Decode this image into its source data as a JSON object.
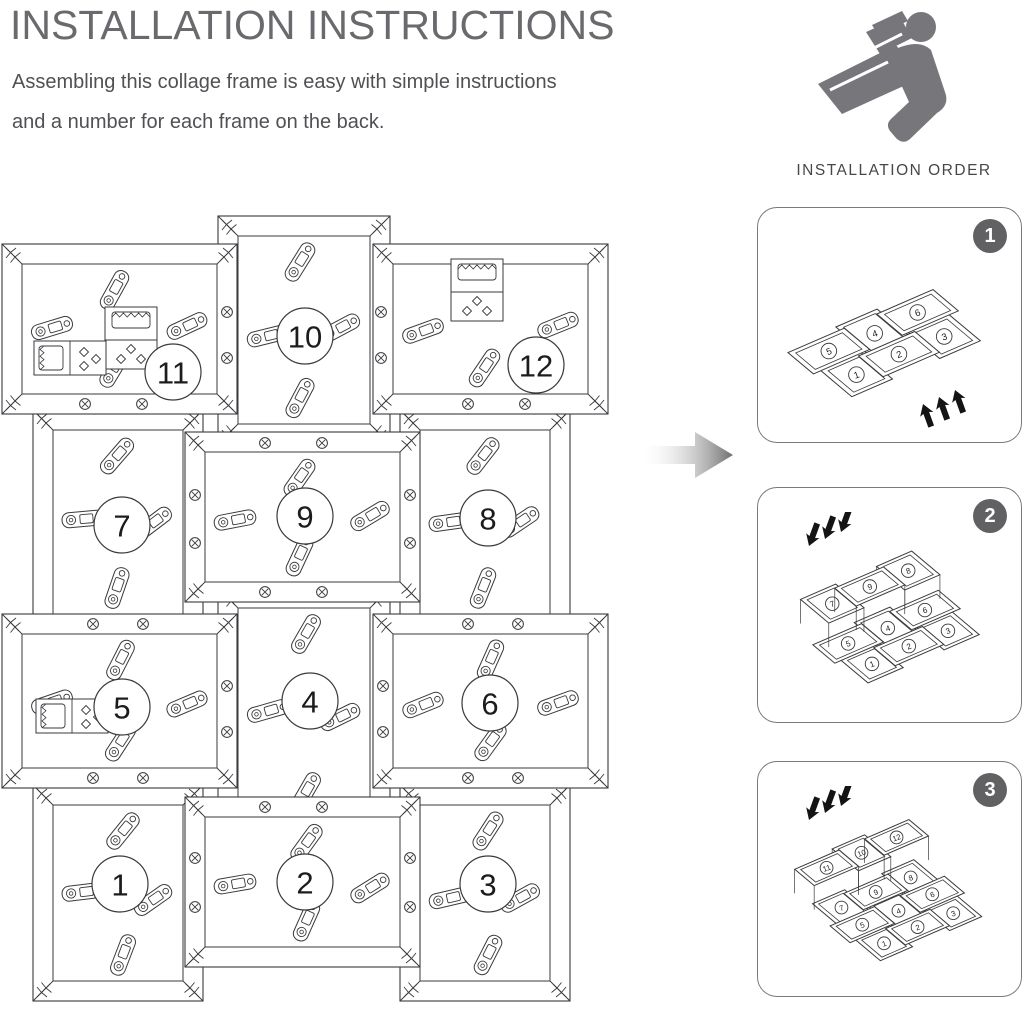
{
  "header": {
    "title": "INSTALLATION INSTRUCTIONS",
    "subtitle_line1": "Assembling this collage frame is easy with simple instructions",
    "subtitle_line2": "and a number for each frame on the back."
  },
  "order_guide": {
    "icon": "person-reading-manual-icon",
    "label": "INSTALLATION ORDER"
  },
  "main_diagram": {
    "description": "Back view of assembled 12-opening collage frame with numbered backs, rotating clips, screws and sawtooth hangers",
    "frame_numbers": [
      1,
      2,
      3,
      4,
      5,
      6,
      7,
      8,
      9,
      10,
      11,
      12
    ]
  },
  "steps": [
    {
      "badge": "1",
      "frames": [
        5,
        4,
        6,
        1,
        2,
        3
      ],
      "raised_frames": [],
      "arrows": "push-up-from-front"
    },
    {
      "badge": "2",
      "frames": [
        5,
        4,
        6,
        1,
        2,
        3
      ],
      "raised_frames": [
        7,
        9,
        8
      ],
      "arrows": "press-down"
    },
    {
      "badge": "3",
      "frames": [
        5,
        4,
        6,
        1,
        2,
        3,
        7,
        9,
        8
      ],
      "raised_frames": [
        11,
        10,
        12
      ],
      "arrows": "press-down"
    }
  ],
  "colors": {
    "line": "#3a3a3e",
    "badge": "#616164",
    "icon_gray": "#77777b",
    "arrow_gradient_end": "#6f6f6f",
    "arrow_black": "#141414"
  }
}
